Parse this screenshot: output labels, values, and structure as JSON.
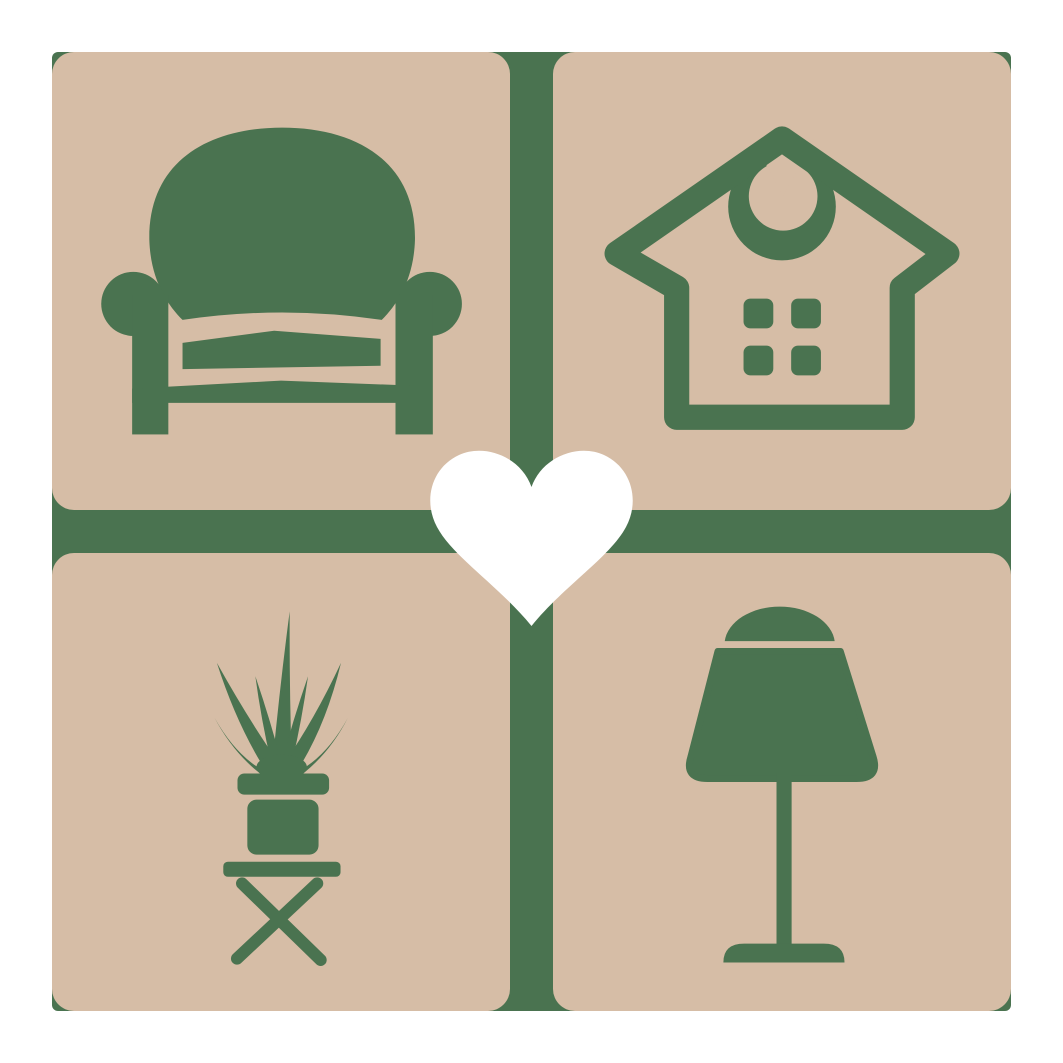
{
  "colors": {
    "background": "#ffffff",
    "tan": "#d6bda6",
    "green": "#4a7350",
    "white": "#ffffff"
  },
  "logo": {
    "kind": "home-decor-love-logo",
    "grid": "2x2-rounded-tiles-with-green-cross-divider"
  },
  "tiles": [
    {
      "position": "top-left",
      "icon": "armchair-icon"
    },
    {
      "position": "top-right",
      "icon": "house-icon"
    },
    {
      "position": "bottom-left",
      "icon": "potted-plant-icon"
    },
    {
      "position": "bottom-right",
      "icon": "table-lamp-icon"
    }
  ],
  "center": {
    "icon": "heart-icon"
  }
}
